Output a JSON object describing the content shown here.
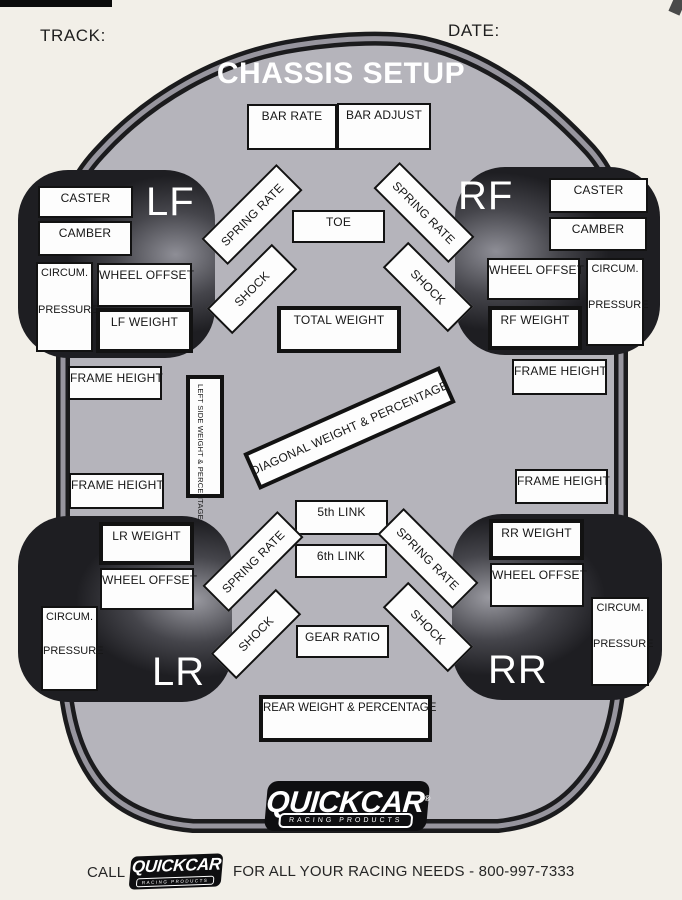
{
  "header": {
    "track_label": "TRACK:",
    "date_label": "DATE:",
    "title": "CHASSIS SETUP"
  },
  "fields": {
    "bar_rate": "BAR RATE",
    "bar_adjust": "BAR ADJUST",
    "toe": "TOE",
    "total_weight": "TOTAL WEIGHT",
    "frame_height": "FRAME HEIGHT",
    "left_side_weight": "LEFT SIDE WEIGHT & PERCENTAGE",
    "diagonal_weight": "DIAGONAL WEIGHT & PERCENTAGE",
    "fifth_link": "5th LINK",
    "sixth_link": "6th LINK",
    "gear_ratio": "GEAR RATIO",
    "rear_weight": "REAR WEIGHT & PERCENTAGE",
    "spring_rate": "SPRING RATE",
    "shock": "SHOCK",
    "caster": "CASTER",
    "camber": "CAMBER",
    "circum": "CIRCUM.",
    "pressure": "PRESSURE",
    "wheel_offset": "WHEEL OFFSET"
  },
  "corners": {
    "lf": {
      "label": "LF",
      "weight": "LF WEIGHT"
    },
    "rf": {
      "label": "RF",
      "weight": "RF WEIGHT"
    },
    "lr": {
      "label": "LR",
      "weight": "LR WEIGHT"
    },
    "rr": {
      "label": "RR",
      "weight": "RR WEIGHT"
    }
  },
  "logo": {
    "brand": "QUICKCAR",
    "reg": "®",
    "tagline": "RACING PRODUCTS"
  },
  "footer": {
    "call_label": "CALL",
    "message": "FOR ALL YOUR RACING NEEDS - 800-997-7333"
  },
  "colors": {
    "background": "#f2efe8",
    "body_fill": "#b5b4bb",
    "body_outline": "#1b1b1d",
    "band_highlight": "#97959e",
    "box_border": "#121212",
    "tire_dark": "#1a1a1d",
    "logo_bg": "#0e0e10"
  }
}
